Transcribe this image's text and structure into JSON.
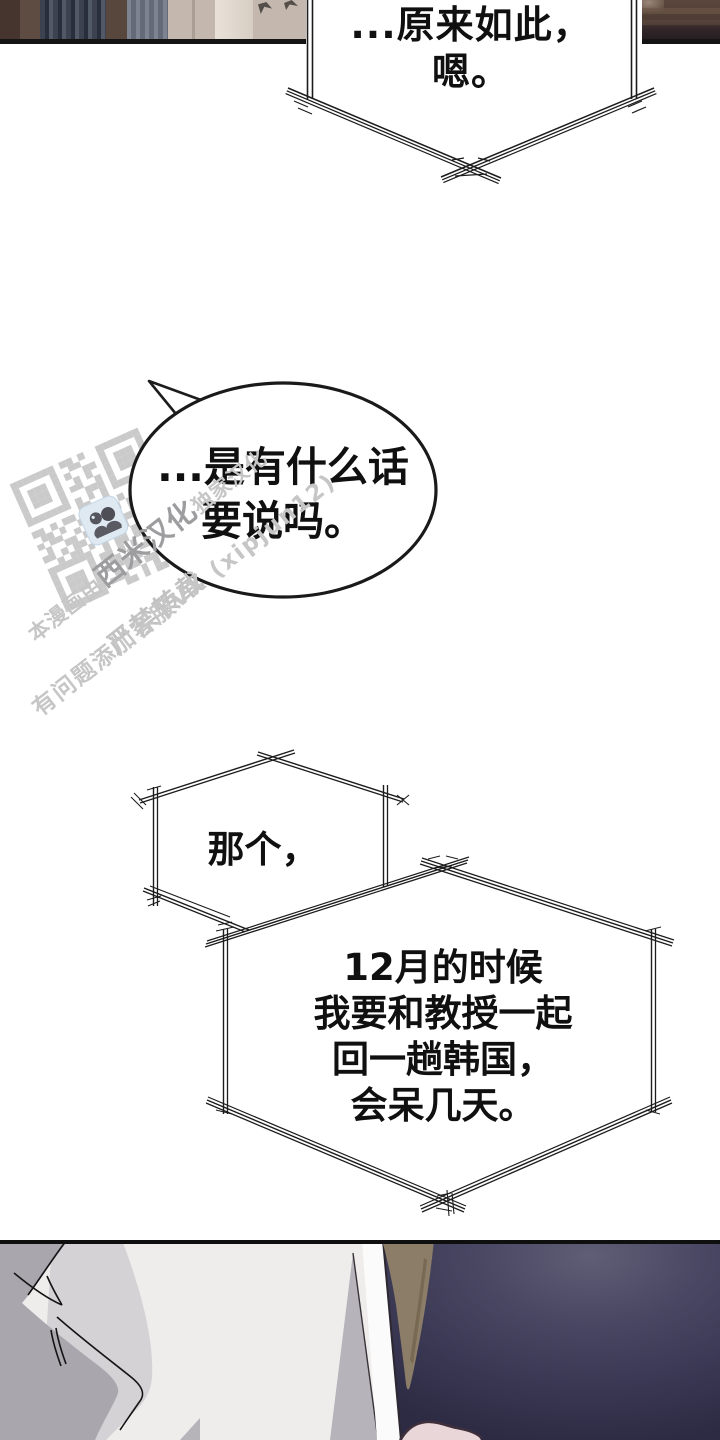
{
  "page": {
    "width": 720,
    "height": 1440,
    "background": "#ffffff",
    "kind": "manhwa-comic-page"
  },
  "palette": {
    "ink": "#1c1c1c",
    "bubble_fill": "#ffffff",
    "qr_gray": "#cacaca",
    "watermark_gray": "#c6c6c6",
    "watermark_brand": "#9d9da0",
    "scene_beige": "#c4b8ae",
    "brick_brown": "#4e3d34",
    "navy_dark": "#2d2b43",
    "navy_light": "#605d76",
    "hair_brown": "#8c7d68",
    "skin_pink": "#e9d6d8",
    "figure_gray": "#a9a6ae",
    "figure_gray_light": "#d4d2d5",
    "wall_white": "#efedeb"
  },
  "bubbles": {
    "top": {
      "shape": "angular-burst",
      "lines": [
        "...原来如此，",
        "嗯。"
      ]
    },
    "oval": {
      "shape": "ellipse",
      "lines": [
        "...是有什么话",
        "要说吗。"
      ]
    },
    "hex1": {
      "shape": "hexagon",
      "lines": [
        "那个，"
      ]
    },
    "hex2": {
      "shape": "hexagon",
      "lines": [
        "12月的时候",
        "我要和教授一起",
        "回一趟韩国，",
        "会呆几天。"
      ]
    }
  },
  "watermark": {
    "line1": {
      "prefix": "本漫画由",
      "brand": "西米汉化",
      "suffix": "独家汉化"
    },
    "line2": "严禁转载",
    "line3": "有问题添加客服VX (xipjun12)",
    "qr": {
      "cell": 6.67,
      "color": "#cacaca",
      "logo": "two-figures-icon",
      "matrix": [
        "111111101101001111111",
        "100000100110001000001",
        "101110101001101011101",
        "101110100101001011101",
        "101110101100101011101",
        "100000100011101000001",
        "111111101010101111111",
        "000000001100100000000",
        "110101100101101011010",
        "011010011010010110011",
        "101100101101100101101",
        "010011010010011010110",
        "110101101101010011011",
        "001011010101101001010",
        "111111100101101011010",
        "100000101101010110101",
        "101110100110101101100",
        "101110101011010010111",
        "101110100101101100010",
        "100000101110010101101",
        "111111100011010110100"
      ]
    }
  }
}
